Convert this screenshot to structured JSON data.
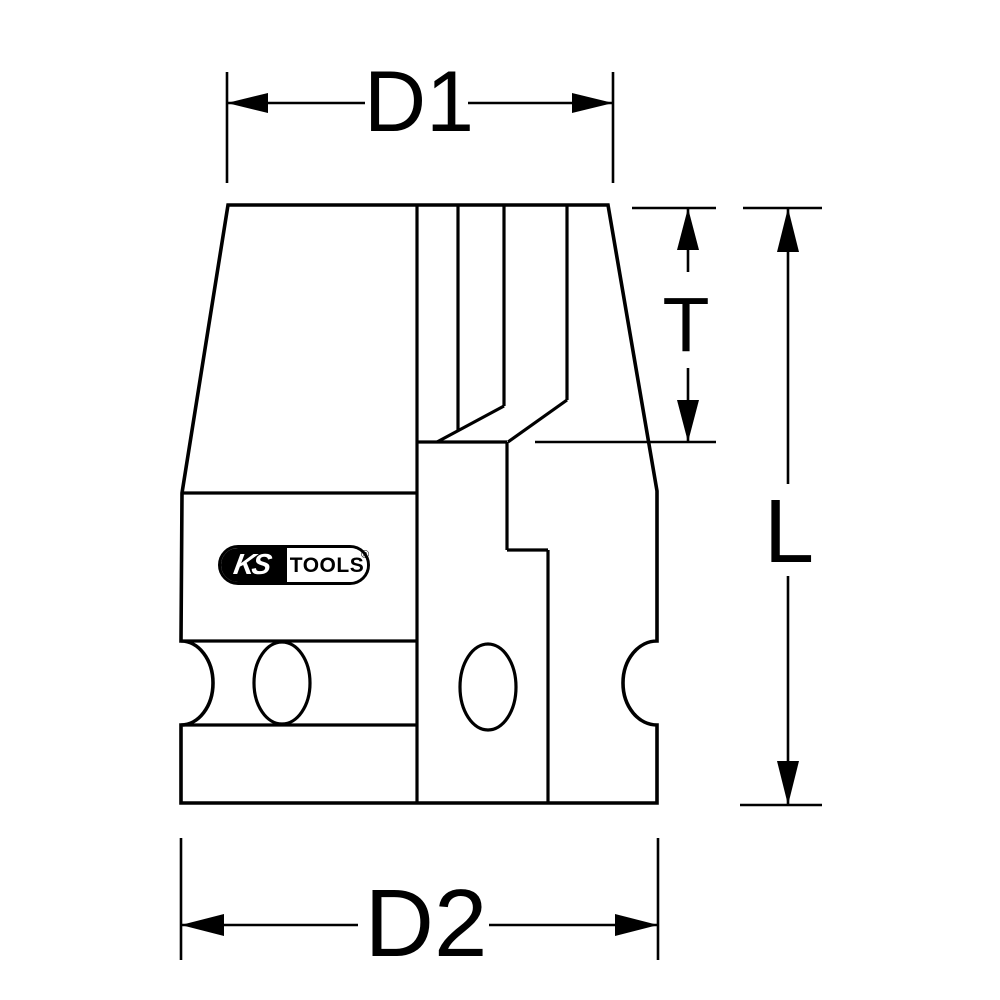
{
  "page": {
    "background": "#ffffff",
    "line_color": "#000000"
  },
  "dimensions": {
    "d1": "D1",
    "t": "T",
    "l": "L",
    "d2": "D2"
  },
  "logo": {
    "ks": "KS",
    "tools": "TOOLS",
    "registered": "®"
  }
}
